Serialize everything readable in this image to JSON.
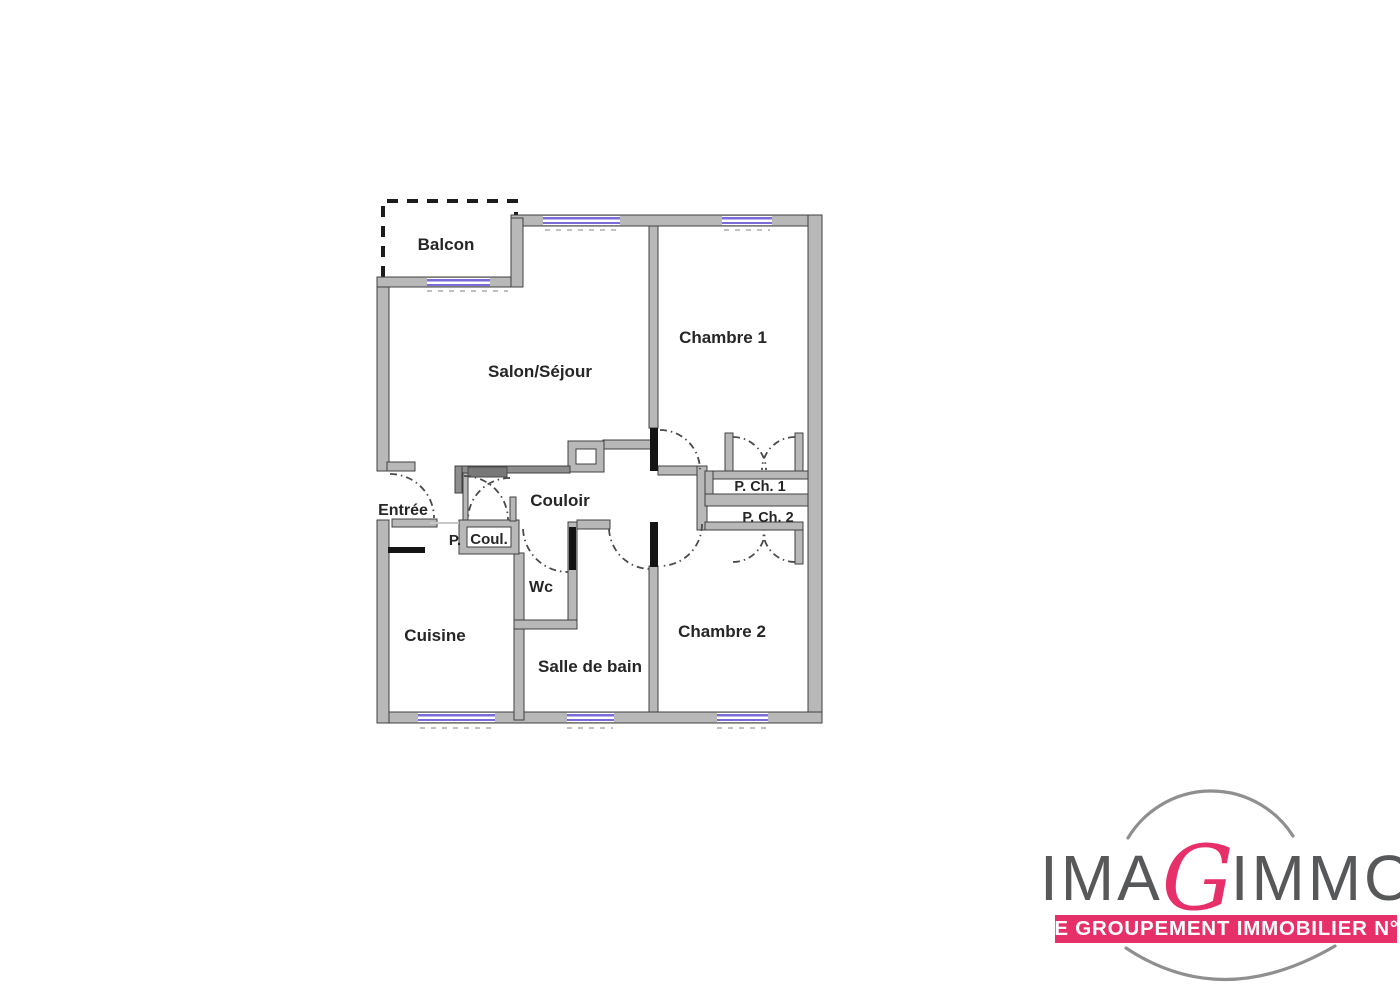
{
  "floorplan": {
    "rooms": {
      "balcon": "Balcon",
      "salon": "Salon/Séjour",
      "chambre1": "Chambre 1",
      "entree": "Entrée",
      "couloir": "Couloir",
      "placard_couloir_p": "P.",
      "placard_couloir": "Coul.",
      "wc": "Wc",
      "cuisine": "Cuisine",
      "salle_de_bain": "Salle de bain",
      "chambre2": "Chambre 2",
      "placard_chambre1": "P. Ch. 1",
      "placard_chambre2": "P. Ch. 2"
    },
    "colors": {
      "wall_fill": "#b8b8b8",
      "wall_outline": "#404040",
      "window": "#7a6cd8",
      "door": "#141414"
    }
  },
  "logo": {
    "brand_pre": "IMA",
    "brand_accent": "G",
    "brand_post": "IMMO",
    "tagline": "LE GROUPEMENT IMMOBILIER N°1",
    "accent_color": "#e73069",
    "text_color": "#57585a"
  }
}
